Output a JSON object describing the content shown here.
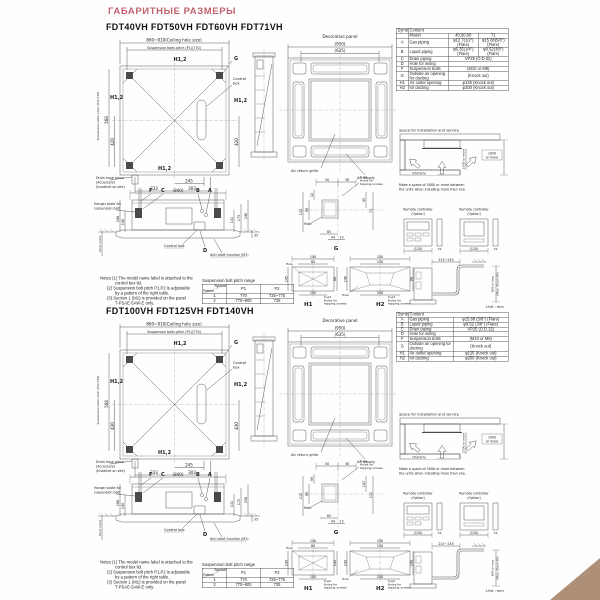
{
  "page": {
    "header": "ГАБАРИТНЫЕ РАЗМЕРЫ",
    "header_color": "#c1636e",
    "corner_color": "#ae9078"
  },
  "sections": [
    {
      "title": "FDT40VH FDT50VH FDT60VH FDT71VH",
      "topview": {
        "ceil": "860~910(Ceiling hole size)",
        "pitch": "Suspension bolts pitch (P1)(770)",
        "pitchL": "Suspension bolts pitch (P1)(770)",
        "h12": "H1,2",
        "g": "G",
        "cb1": "Control",
        "cb2": "box",
        "d568": "568",
        "dL": "420",
        "dR": "420",
        "d245": "245",
        "d333": "333",
        "d303": "303",
        "dr1": "Drain hose piece",
        "dr2": "(Accessory)",
        "dr3": "(Installed on site)"
      },
      "panel": {
        "title": "Decorative panel",
        "d950": "(950)",
        "d635": "(635)",
        "ret": "Air return grille",
        "sup": "Air supply"
      },
      "table": {
        "cols": [
          24,
          80,
          60,
          60
        ],
        "rows": [
          [
            {
              "t": "Symbol"
            },
            {
              "t": "Content",
              "c": 3
            }
          ],
          [
            {
              "t": ""
            },
            {
              "t": "Model"
            },
            {
              "t": "40,50,60"
            },
            {
              "t": "71"
            }
          ],
          [
            {
              "t": "A"
            },
            {
              "t": "Gas piping"
            },
            {
              "t": "φ12.7(1/2\") (Flare)"
            },
            {
              "t": "φ15.88(5/8\") (Flare)"
            }
          ],
          [
            {
              "t": "B"
            },
            {
              "t": "Liquid piping"
            },
            {
              "t": "φ6.35(1/4\") (Flare)"
            },
            {
              "t": "φ9.52(3/8\") (Flare)"
            }
          ],
          [
            {
              "t": "C"
            },
            {
              "t": "Drain piping"
            },
            {
              "t": "VP25 (O.D.32)",
              "c": 2
            }
          ],
          [
            {
              "t": "D"
            },
            {
              "t": "Hole for wiring"
            },
            {
              "t": "",
              "c": 2
            }
          ],
          [
            {
              "t": "F"
            },
            {
              "t": "Suspension bolts"
            },
            {
              "t": "(M10 or M8)",
              "c": 2
            }
          ],
          [
            {
              "t": "G"
            },
            {
              "t": "Outside air opening for ducting"
            },
            {
              "t": "(Knock out)",
              "c": 2
            }
          ],
          [
            {
              "t": "H1"
            },
            {
              "t": "Air outlet opening"
            },
            {
              "t": "φ125 (Knock out)",
              "c": 2
            }
          ],
          [
            {
              "t": "H2"
            },
            {
              "t": "for ducting"
            },
            {
              "t": "φ200 (Knock out)",
              "c": 2
            }
          ]
        ]
      },
      "space": {
        "title": "Space for installation and service",
        "obstacle": "Obstacle",
        "v": "2500 or more",
        "r1": "1000",
        "r2": "or more",
        "cap1": "Make a space of 5000 or more between",
        "cap2": "the units when installing more than one."
      },
      "remote": {
        "l1": "Remote controller",
        "l2": "(Option)",
        "d120": "(120)",
        "d19": "19"
      },
      "drain": {
        "d": "215~245",
        "l1": "850 or less",
        "l2": "(Max. Drain lift)",
        "unit": "Unit : mm"
      },
      "sideview": {
        "d840": "(840)",
        "f": "F",
        "c": "C",
        "b": "B",
        "a": "A",
        "d": "D",
        "h1": "Hanger plate for",
        "h2": "suspension bolt",
        "cbox": "Control box",
        "anti": "Anti draft function (M1)",
        "dl1": "188",
        "dl2": "140",
        "d50": "50 or more",
        "r1": "131",
        "r2": "173",
        "r3": "246",
        "r4": "35"
      },
      "notes": {
        "n1": "Notes (1) The model name label is attached to the",
        "n2": "control box lid.",
        "n3": "(2) Suspension bolt pitch P1,P2 is adjustable",
        "n4": "by a pattern of the right table.",
        "n5": "(3) Section 1 (M1) is provided on the panel",
        "n6": "T-PSAE-5AW-E only."
      },
      "pitch": {
        "title": "Suspension bolt pitch range",
        "sym": "Symbol",
        "pat": "Pattern",
        "p1": "P1",
        "p2": "P2",
        "rows": [
          [
            "1",
            "770",
            "725~775"
          ],
          [
            "2",
            "770~800",
            "725"
          ]
        ]
      },
      "details": {
        "tap5a": "5-φ4",
        "tap6a": "6-φ4",
        "tapb": "Holes for",
        "tapc": "tapping screws",
        "hole": "Hole",
        "g": "G",
        "h1": "H1",
        "h2": "H2",
        "gt1": "50",
        "gt2": "38",
        "gl1": "32",
        "gl2": "132",
        "gl3": "60",
        "gr1": "45",
        "gr2": "73",
        "gb1": "85",
        "gb2": "44",
        "gb3": "13",
        "h1t1": "140",
        "h1t2": "84",
        "h1r": "88",
        "h1l": "145",
        "h1b": "100",
        "h2t1": "240",
        "h2t2": "130",
        "h2r": "88",
        "h2l": "140",
        "h2b": "200"
      }
    },
    {
      "title": "FDT100VH FDT125VH FDT140VH",
      "topview": {
        "ceil": "860~910(Ceiling hole size)",
        "pitch": "Suspension bolts pitch (P1)(770)",
        "pitchL": "Suspension bolts pitch (P1)(770)",
        "h12": "H1,2",
        "g": "G",
        "cb1": "Control",
        "cb2": "box",
        "d568": "568",
        "dL": "430",
        "dR": "430",
        "d245": "245",
        "d333": "333",
        "d303": "303",
        "dr1": "Drain hose piece",
        "dr2": "(Accessory)",
        "dr3": "(Installed on site)"
      },
      "panel": {
        "title": "Decorative panel",
        "d950": "(950)",
        "d635": "(635)",
        "ret": "Air return grille",
        "sup": "Air supply"
      },
      "table": {
        "cols": [
          24,
          90,
          110
        ],
        "rows": [
          [
            {
              "t": "Symbol"
            },
            {
              "t": "Content",
              "c": 2
            }
          ],
          [
            {
              "t": "A"
            },
            {
              "t": "Gas piping"
            },
            {
              "t": "φ15.88 (5/8\") (Flare)"
            }
          ],
          [
            {
              "t": "B"
            },
            {
              "t": "Liquid piping"
            },
            {
              "t": "φ9.52 (3/8\") (Flare)"
            }
          ],
          [
            {
              "t": "C"
            },
            {
              "t": "Drain piping"
            },
            {
              "t": "VP25 (O.D.32)"
            }
          ],
          [
            {
              "t": "D"
            },
            {
              "t": "Hole for wiring"
            },
            {
              "t": ""
            }
          ],
          [
            {
              "t": "F"
            },
            {
              "t": "Suspension bolts"
            },
            {
              "t": "(M10 or M8)"
            }
          ],
          [
            {
              "t": "G"
            },
            {
              "t": "Outside air opening for ducting"
            },
            {
              "t": "(Knock out)"
            }
          ],
          [
            {
              "t": "H1"
            },
            {
              "t": "Air outlet opening"
            },
            {
              "t": "φ125 (Knock out)"
            }
          ],
          [
            {
              "t": "H2"
            },
            {
              "t": "for ducting"
            },
            {
              "t": "φ200 (Knock out)"
            }
          ]
        ]
      },
      "space": {
        "title": "Space for installation and service",
        "obstacle": "Obstacle",
        "v": "2500 or more",
        "r1": "1000",
        "r2": "or more",
        "cap1": "Make a space of 5000 or more between",
        "cap2": "the units when installing more than one."
      },
      "remote": {
        "l1": "Remote controller",
        "l2": "(Option)",
        "d120": "(120)",
        "d19": "19"
      },
      "drain": {
        "d": "215~245",
        "l1": "850 or less",
        "l2": "(Max. Drain lift)",
        "unit": "Unit : mm"
      },
      "sideview": {
        "d840": "(840)",
        "f": "F",
        "c": "C",
        "b": "B",
        "a": "A",
        "d": "D",
        "h1": "Hanger plate for",
        "h2": "suspension bolt",
        "cbox": "Control box",
        "anti": "Anti draft function (M1)",
        "dl1": "188",
        "dl2": "140",
        "d50": "50 or more",
        "r1": "131",
        "r2": "172",
        "r3": "298",
        "r4": "35"
      },
      "notes": {
        "n1": "Notes (1) The model name label is attached to the",
        "n2": "control box lid.",
        "n3": "(2) Suspension bolt pitch P1,P2 is adjustable",
        "n4": "by a pattern of the right table.",
        "n5": "(3) Section 1 (M1) is provided on the panel",
        "n6": "T-PSAE-5AW-E only."
      },
      "pitch": {
        "title": "Suspension bolt pitch range",
        "sym": "Symbol",
        "pat": "Pattern",
        "p1": "P1",
        "p2": "P2",
        "rows": [
          [
            "1",
            "770",
            "725~775"
          ],
          [
            "2",
            "770~800",
            "725"
          ]
        ]
      },
      "details": {
        "tap5a": "5-φ4",
        "tap6a": "6-φ4",
        "tapb": "Holes for",
        "tapc": "tapping screws",
        "hole": "Hole",
        "g": "G",
        "h1": "H1",
        "h2": "H2",
        "gt1": "50",
        "gt2": "38",
        "gl1": "99",
        "gl2": "132",
        "gl3": "60",
        "gr1": "147",
        "gr2": "112",
        "gb1": "85",
        "gb2": "44",
        "gb3": "13",
        "h1t1": "140",
        "h1t2": "84",
        "h1r": "140",
        "h1l": "140",
        "h1b": "100",
        "h2t1": "240",
        "h2t2": "130",
        "h2r": "140",
        "h2l": "140",
        "h2b": "200"
      }
    }
  ]
}
